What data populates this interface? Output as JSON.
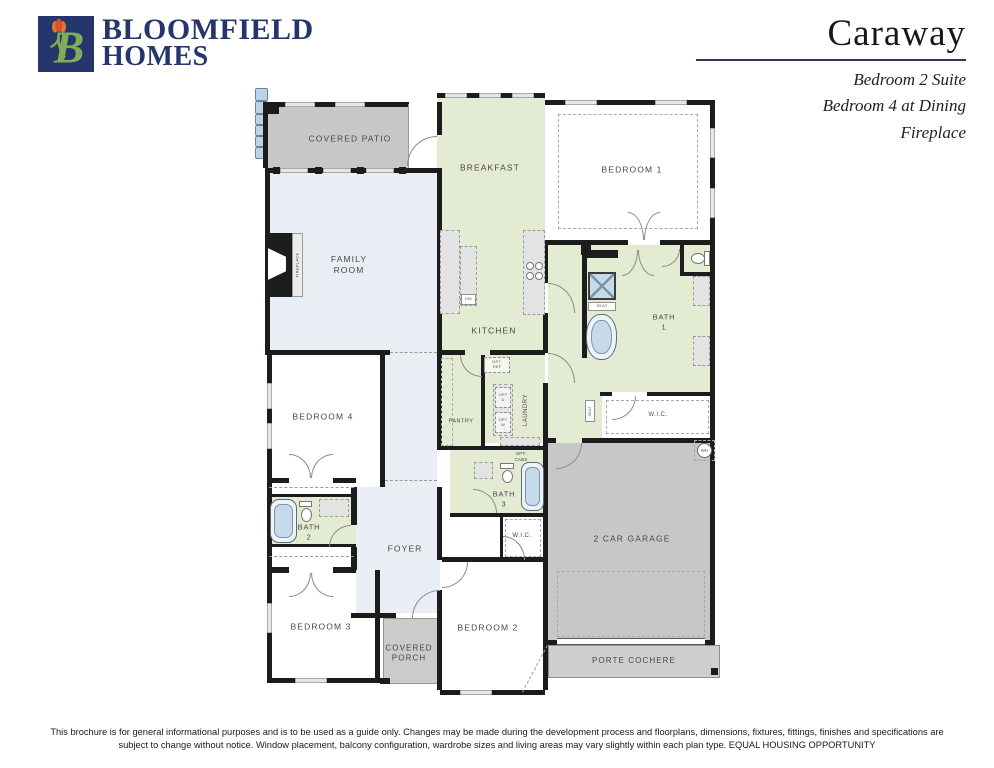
{
  "header": {
    "logo_line1": "BLOOMFIELD",
    "logo_line2": "HOMES",
    "plan_name": "Caraway",
    "options": [
      "Bedroom 2 Suite",
      "Bedroom 4 at Dining",
      "Fireplace"
    ]
  },
  "plan": {
    "covered_patio": "COVERED PATIO",
    "breakfast": "BREAKFAST",
    "bedroom1": "BEDROOM 1",
    "family_room": "FAMILY\nROOM",
    "fireplace": "FIREPLACE",
    "kitchen": "KITCHEN",
    "dw": "DW",
    "opt_ref": "OPT.\nREF",
    "pantry": "PANTRY",
    "laundry": "LAUNDRY",
    "opt_d": "OPT\nD",
    "opt_w": "OPT\nW",
    "opt_cabs": "OPT.\nCABS",
    "bath1": "BATH\n1",
    "seat_shower": "SEAT",
    "seat_hall": "SEAT",
    "wic_master": "W.I.C.",
    "wh": "WH",
    "bedroom4": "BEDROOM 4",
    "bath2": "BATH\n2",
    "foyer": "FOYER",
    "bath3": "BATH\n3",
    "wic_bed2": "W.I.C.",
    "bedroom3": "BEDROOM 3",
    "covered_porch": "COVERED\nPORCH",
    "bedroom2": "BEDROOM 2",
    "garage": "2 CAR GARAGE",
    "porte_cochere": "PORTE COCHERE"
  },
  "footer": {
    "line1": "This brochure is for general informational purposes and is to be used as a guide only. Changes may be made during the development process and floorplans, dimensions, fixtures, fittings, finishes and specifications are",
    "line2": "subject to change without notice. Window placement, balcony configuration, wardrobe sizes and living areas may vary slightly within each plan type.  EQUAL HOUSING OPPORTUNITY"
  },
  "colors": {
    "brand_navy": "#24366b",
    "logo_green": "#7fae57",
    "tulip_orange": "#e07b2a",
    "room_green": "#e3ecd3",
    "room_blue": "#e9eef4",
    "area_gray": "#c7c7c7",
    "fixture_blue": "#c6dbea",
    "wall_black": "#1c1c1c"
  }
}
